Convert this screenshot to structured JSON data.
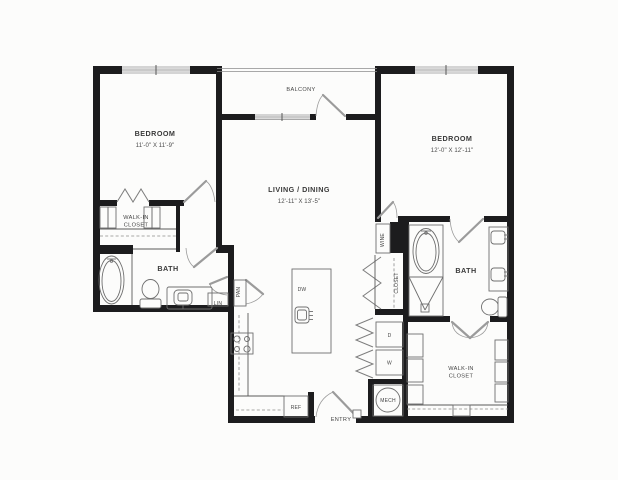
{
  "plan": {
    "type": "apartment-floor-plan",
    "palette": {
      "wall": "#1c1c1e",
      "thin_line": "#5a5a5a",
      "window": "#c9c9c9",
      "door": "#9b9b9b",
      "text": "#3a3a3a",
      "background": "#fcfcfb"
    },
    "rooms": {
      "bedroom1": {
        "label": "BEDROOM",
        "dimensions": "11'-0\" X 11'-9\""
      },
      "bedroom2": {
        "label": "BEDROOM",
        "dimensions": "12'-0\" X 12'-11\""
      },
      "living_dining": {
        "label": "LIVING / DINING",
        "dimensions": "12'-11\" X 13'-5\""
      },
      "balcony": {
        "label": "BALCONY"
      },
      "walk_in_closet_1": {
        "line1": "WALK-IN",
        "line2": "CLOSET"
      },
      "walk_in_closet_2": {
        "line1": "WALK-IN",
        "line2": "CLOSET"
      },
      "bath1": {
        "label": "BATH"
      },
      "bath2": {
        "label": "BATH"
      },
      "hall_closet": {
        "label": "CLOSET"
      },
      "entry": {
        "label": "ENTRY"
      }
    },
    "fixtures": {
      "linen": "LIN",
      "pantry": "PAN",
      "wine": "WINE",
      "dishwasher": "DW",
      "refrigerator": "REF",
      "dryer": "D",
      "washer": "W",
      "mechanical": "MECH"
    }
  }
}
